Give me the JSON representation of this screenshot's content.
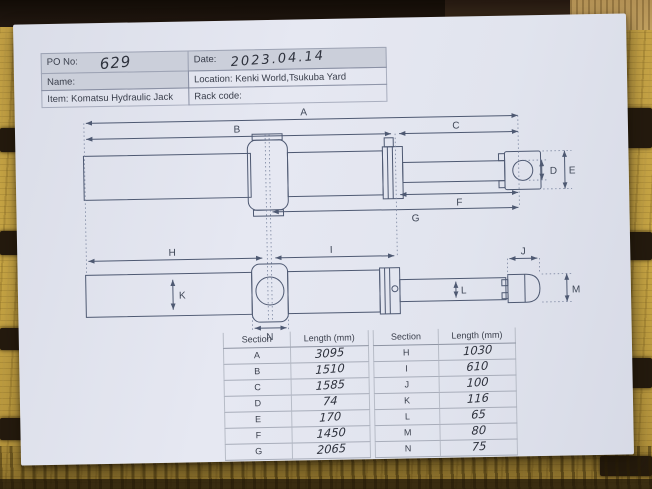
{
  "header": {
    "po_label": "PO No:",
    "po_value": "629",
    "date_label": "Date:",
    "date_value": "2023.04.14",
    "name_label": "Name:",
    "location_label": "Location: Kenki World,Tsukuba Yard",
    "item_label": "Item: Komatsu Hydraulic Jack",
    "rack_label": "Rack code:"
  },
  "dim_labels": {
    "A": "A",
    "B": "B",
    "C": "C",
    "D": "D",
    "E": "E",
    "F": "F",
    "G": "G",
    "H": "H",
    "I": "I",
    "J": "J",
    "K": "K",
    "L": "L",
    "M": "M",
    "N": "N"
  },
  "tables": {
    "left": {
      "section_header": "Section",
      "length_header": "Length (mm)",
      "rows": [
        [
          "A",
          "3095"
        ],
        [
          "B",
          "1510"
        ],
        [
          "C",
          "1585"
        ],
        [
          "D",
          "74"
        ],
        [
          "E",
          "170"
        ],
        [
          "F",
          "1450"
        ],
        [
          "G",
          "2065"
        ]
      ]
    },
    "right": {
      "section_header": "Section",
      "length_header": "Length (mm)",
      "rows": [
        [
          "H",
          "1030"
        ],
        [
          "I",
          "610"
        ],
        [
          "J",
          "100"
        ],
        [
          "K",
          "116"
        ],
        [
          "L",
          "65"
        ],
        [
          "M",
          "80"
        ],
        [
          "N",
          "75"
        ]
      ]
    }
  },
  "dimensions_mm": {
    "A": 3095,
    "B": 1510,
    "C": 1585,
    "D": 74,
    "E": 170,
    "F": 1450,
    "G": 2065,
    "H": 1030,
    "I": 610,
    "J": 100,
    "K": 116,
    "L": 65,
    "M": 80,
    "N": 75
  },
  "colors": {
    "paper": "#e3e6f0",
    "drawing_line": "#4e5972",
    "wood": "#c7a544",
    "wood_dark": "#241a0e",
    "header_cell_gray": "#cbcfda"
  }
}
